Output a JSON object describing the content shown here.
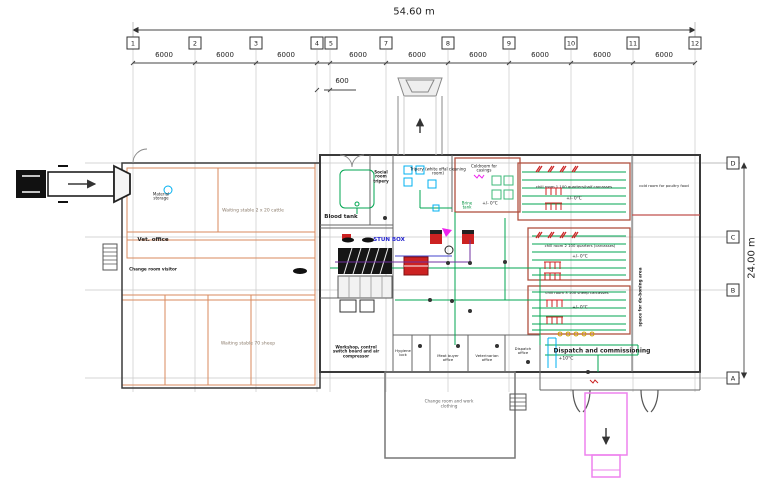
{
  "dimensions": {
    "overall_width": "54.60 m",
    "overall_height": "24.00 m",
    "bay_spacing": "6000",
    "small_bay": "600"
  },
  "grid": {
    "columns": [
      "1",
      "2",
      "3",
      "4",
      "5",
      "7",
      "8",
      "9",
      "10",
      "11",
      "12"
    ],
    "rows": [
      "D",
      "C",
      "B",
      "A"
    ]
  },
  "rooms": {
    "material_storage": "Material storage",
    "vet_office": "Vet. office",
    "change_room_visitor": "Change room visitor",
    "waiting_stable_cattle": "Waiting stable 2 x 20 cattle",
    "waiting_stable_sheep": "Waiting stable 70 sheep",
    "blood_tank": "Blood tank",
    "social_room": "Social room tripery",
    "tripery": "Tripery (white offal cleaning room)",
    "coldroom_casings": "Coldroom for casings",
    "brine_tank": "Brine tank",
    "stun_box": "STUN BOX",
    "workshop": "Workshop, control switch board and air compressor",
    "hygiene_lock": "Hygiene lock",
    "meat_buyer_office": "Meat buyer office",
    "veterinarian_office": "Veterinarian office",
    "dispatch_office": "Dispatch office",
    "dispatch": "Dispatch and commissioning",
    "dispatch_temp": "+10°C",
    "chill_room_1": "chill room 1 100 quarters/half carcasses",
    "chill_room_2": "chill room 2 100 quarters (carcasses)",
    "chill_room_3": "chill room 3 100 sheep carcasses",
    "chill_temp": "+/- 0°C",
    "poultry_coldroom": "cold room for poultry food",
    "deboning_area": "space for de-boning area",
    "change_room_work": "Change room and work clothing"
  },
  "colors": {
    "wall": "#3a3a3a",
    "pen_lines": "#d98a5e",
    "conveyor": "#00a651",
    "chill_wall": "#b05040",
    "hooks": "#cc2222",
    "water": "#00b0f0",
    "truck_outbound": "#ee82ee",
    "stun_label": "#2222cc",
    "grid_line": "#c9c9c9"
  }
}
